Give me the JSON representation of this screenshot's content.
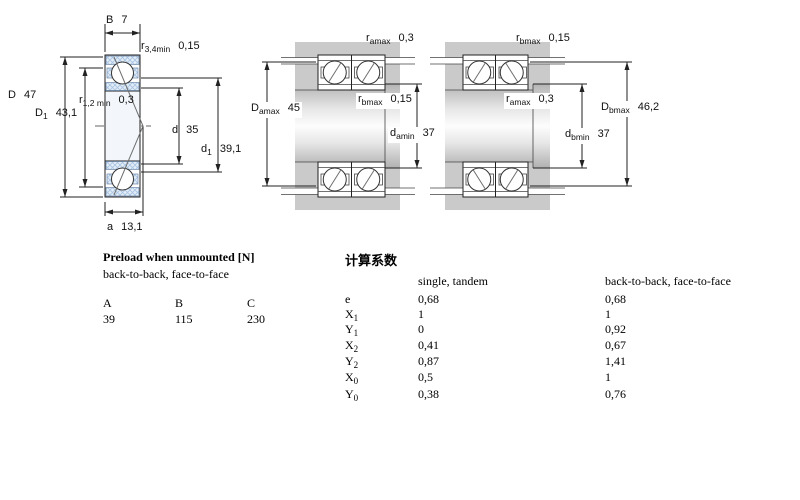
{
  "diagram": {
    "single_bearing": {
      "labels": {
        "width_B": {
          "base": "B",
          "sub": "",
          "value": "7"
        },
        "r_34_min": {
          "base": "r",
          "sub": "3,4min",
          "value": "0,15"
        },
        "outer_D": {
          "base": "D",
          "sub": "",
          "value": "47"
        },
        "D1": {
          "base": "D",
          "sub": "1",
          "value": "43,1"
        },
        "r_12_min": {
          "base": "r",
          "sub": "1,2 min",
          "value": "0,3"
        },
        "bore_d": {
          "base": "d",
          "sub": "",
          "value": "35"
        },
        "d1": {
          "base": "d",
          "sub": "1",
          "value": "39,1"
        },
        "a": {
          "base": "a",
          "sub": "",
          "value": "13,1"
        }
      }
    },
    "arrangement_a": {
      "labels": {
        "r_amax": {
          "base": "r",
          "sub": "amax",
          "value": "0,3"
        },
        "D_amax": {
          "base": "D",
          "sub": "amax",
          "value": "45"
        },
        "r_bmax": {
          "base": "r",
          "sub": "bmax",
          "value": "0,15"
        },
        "d_amin": {
          "base": "d",
          "sub": "amin",
          "value": "37"
        }
      }
    },
    "arrangement_b": {
      "labels": {
        "r_bmax": {
          "base": "r",
          "sub": "bmax",
          "value": "0,15"
        },
        "r_amax": {
          "base": "r",
          "sub": "amax",
          "value": "0,3"
        },
        "d_bmin": {
          "base": "d",
          "sub": "bmin",
          "value": "37"
        },
        "D_bmax": {
          "base": "D",
          "sub": "bmax",
          "value": "46,2"
        }
      }
    }
  },
  "preload_table": {
    "title": "Preload when unmounted [N]",
    "subtitle": "back-to-back, face-to-face",
    "columns": [
      "A",
      "B",
      "C"
    ],
    "values": [
      "39",
      "115",
      "230"
    ]
  },
  "factors_table": {
    "title": "计算系数",
    "col1_header": "single, tandem",
    "col2_header": "back-to-back, face-to-face",
    "rows": [
      {
        "base": "e",
        "sub": "",
        "single": "0,68",
        "paired": "0,68"
      },
      {
        "base": "X",
        "sub": "1",
        "single": "1",
        "paired": "1"
      },
      {
        "base": "Y",
        "sub": "1",
        "single": "0",
        "paired": "0,92"
      },
      {
        "base": "X",
        "sub": "2",
        "single": "0,41",
        "paired": "0,67"
      },
      {
        "base": "Y",
        "sub": "2",
        "single": "0,87",
        "paired": "1,41"
      },
      {
        "base": "X",
        "sub": "0",
        "single": "0,5",
        "paired": "1"
      },
      {
        "base": "Y",
        "sub": "0",
        "single": "0,38",
        "paired": "0,76"
      }
    ]
  },
  "colors": {
    "hatch_blue": "#a9c4e2",
    "hatch_background": "#e3edf7",
    "housing_gray": "#cacaca",
    "line": "#222222"
  }
}
